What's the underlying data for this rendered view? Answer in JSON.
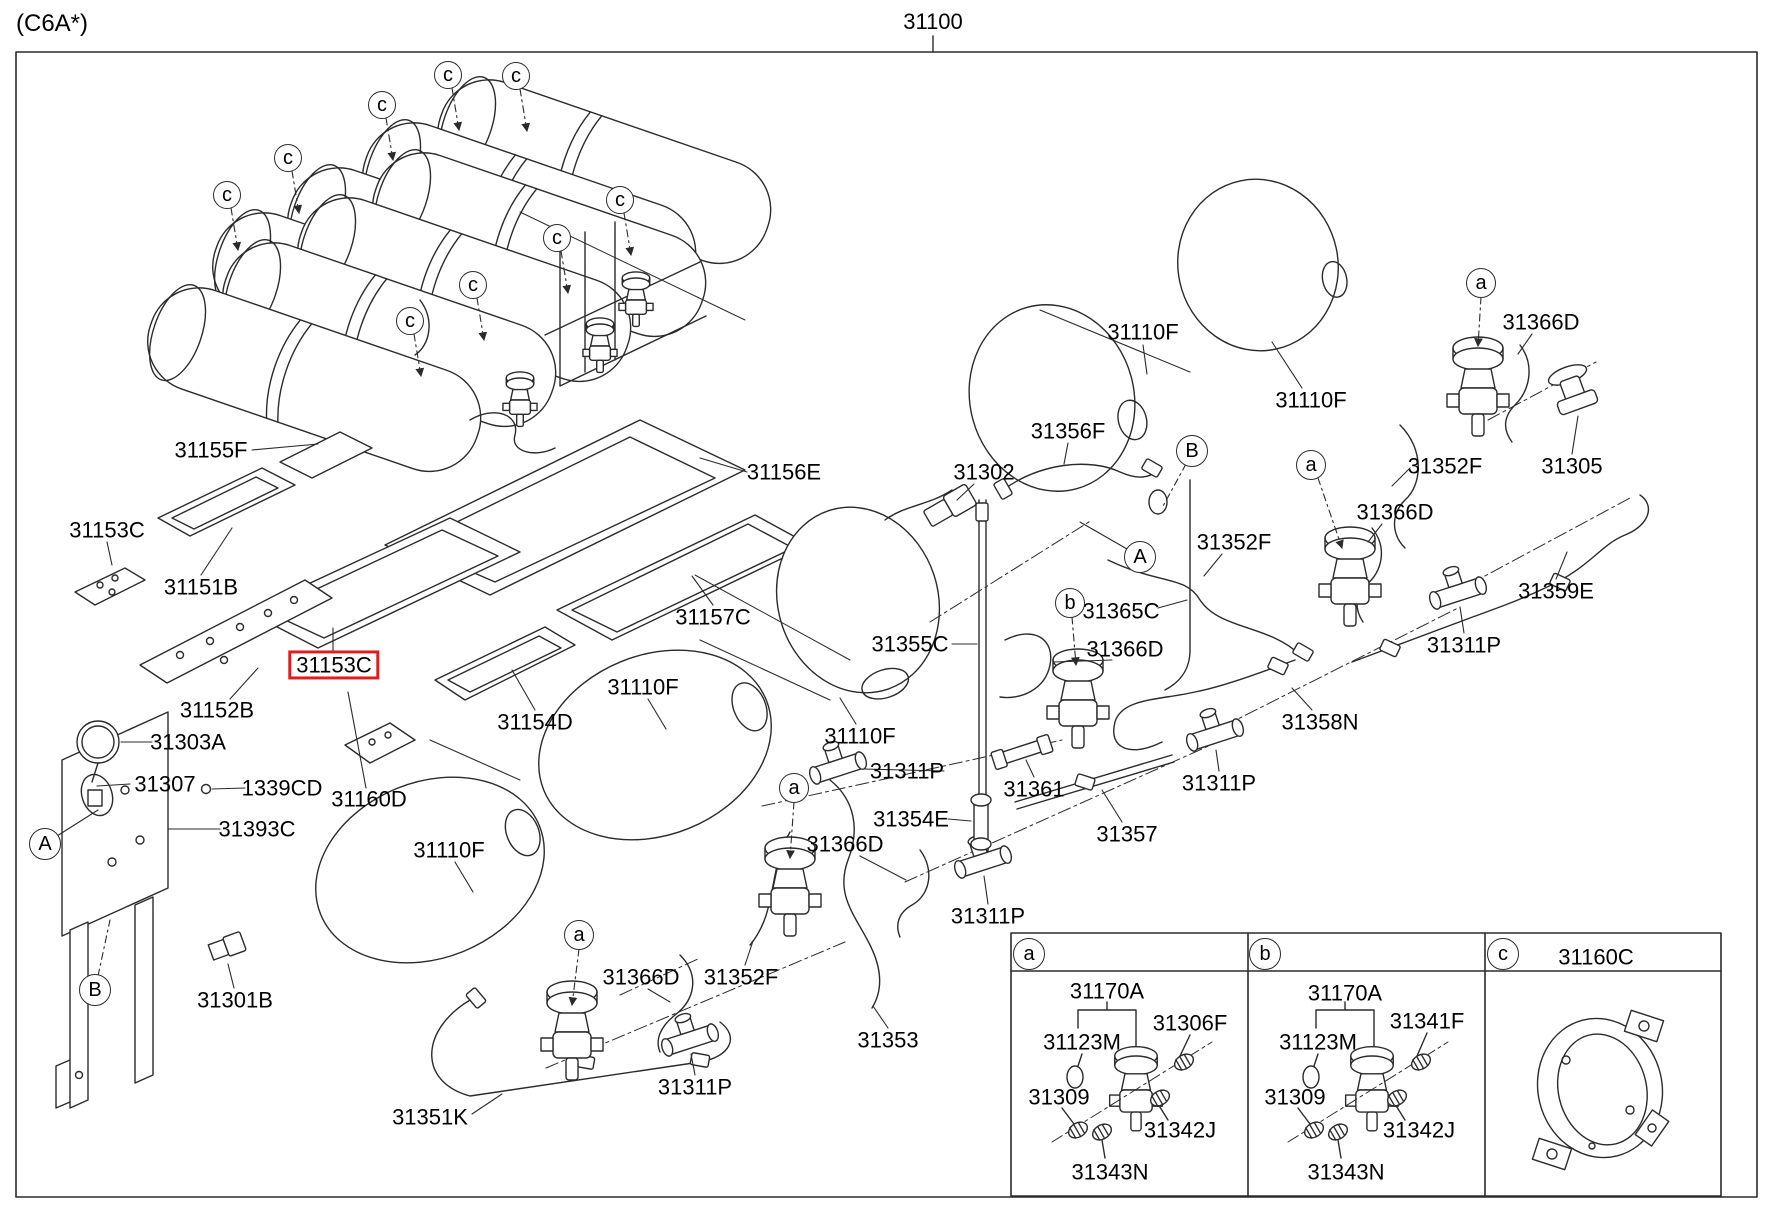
{
  "header": {
    "variant_code": "(C6A*)",
    "assembly_number": "31100"
  },
  "colors": {
    "highlight": "#dd1f1f",
    "line": "#2b2b2b",
    "text": "#000000",
    "background": "#ffffff"
  },
  "highlighted_part": "31153C",
  "labels": [
    {
      "t": "31155F",
      "x": 211,
      "y": 450
    },
    {
      "t": "31153C",
      "x": 107,
      "y": 530
    },
    {
      "t": "31151B",
      "x": 201,
      "y": 587
    },
    {
      "t": "31153C",
      "x": 334,
      "y": 665,
      "hl": true
    },
    {
      "t": "31152B",
      "x": 217,
      "y": 710
    },
    {
      "t": "31303A",
      "x": 188,
      "y": 742
    },
    {
      "t": "31307",
      "x": 165,
      "y": 784
    },
    {
      "t": "1339CD",
      "x": 282,
      "y": 788
    },
    {
      "t": "31160D",
      "x": 369,
      "y": 799
    },
    {
      "t": "31393C",
      "x": 257,
      "y": 829
    },
    {
      "t": "31301B",
      "x": 235,
      "y": 1000
    },
    {
      "t": "31156E",
      "x": 784,
      "y": 472
    },
    {
      "t": "31157C",
      "x": 713,
      "y": 617
    },
    {
      "t": "31154D",
      "x": 535,
      "y": 722
    },
    {
      "t": "31110F",
      "x": 643,
      "y": 687
    },
    {
      "t": "31110F",
      "x": 449,
      "y": 850
    },
    {
      "t": "31110F",
      "x": 860,
      "y": 736
    },
    {
      "t": "31110F",
      "x": 1143,
      "y": 332
    },
    {
      "t": "31110F",
      "x": 1311,
      "y": 400
    },
    {
      "t": "31366D",
      "x": 641,
      "y": 977
    },
    {
      "t": "31366D",
      "x": 845,
      "y": 844
    },
    {
      "t": "31366D",
      "x": 1125,
      "y": 649
    },
    {
      "t": "31366D",
      "x": 1395,
      "y": 512
    },
    {
      "t": "31366D",
      "x": 1541,
      "y": 322
    },
    {
      "t": "31352F",
      "x": 741,
      "y": 977
    },
    {
      "t": "31352F",
      "x": 1234,
      "y": 542
    },
    {
      "t": "31352F",
      "x": 1445,
      "y": 466
    },
    {
      "t": "31311P",
      "x": 907,
      "y": 771
    },
    {
      "t": "31311P",
      "x": 988,
      "y": 916
    },
    {
      "t": "31311P",
      "x": 1219,
      "y": 783
    },
    {
      "t": "31311P",
      "x": 1464,
      "y": 645
    },
    {
      "t": "31311P",
      "x": 695,
      "y": 1087
    },
    {
      "t": "31361",
      "x": 1034,
      "y": 789
    },
    {
      "t": "31354E",
      "x": 911,
      "y": 819
    },
    {
      "t": "31357",
      "x": 1127,
      "y": 834
    },
    {
      "t": "31353",
      "x": 888,
      "y": 1040
    },
    {
      "t": "31351K",
      "x": 430,
      "y": 1117
    },
    {
      "t": "31355C",
      "x": 910,
      "y": 644
    },
    {
      "t": "31365C",
      "x": 1121,
      "y": 611
    },
    {
      "t": "31302",
      "x": 984,
      "y": 472
    },
    {
      "t": "31356F",
      "x": 1068,
      "y": 431
    },
    {
      "t": "31359E",
      "x": 1556,
      "y": 591
    },
    {
      "t": "31358N",
      "x": 1320,
      "y": 722
    },
    {
      "t": "31305",
      "x": 1572,
      "y": 466
    },
    {
      "t": "31160C",
      "x": 1596,
      "y": 957
    },
    {
      "t": "31170A",
      "x": 1107,
      "y": 991
    },
    {
      "t": "31123M",
      "x": 1082,
      "y": 1042
    },
    {
      "t": "31306F",
      "x": 1190,
      "y": 1023
    },
    {
      "t": "31309",
      "x": 1059,
      "y": 1097
    },
    {
      "t": "31342J",
      "x": 1180,
      "y": 1130
    },
    {
      "t": "31343N",
      "x": 1110,
      "y": 1172
    },
    {
      "t": "31170A",
      "x": 1345,
      "y": 993
    },
    {
      "t": "31123M",
      "x": 1318,
      "y": 1042
    },
    {
      "t": "31341F",
      "x": 1427,
      "y": 1021
    },
    {
      "t": "31309",
      "x": 1295,
      "y": 1097
    },
    {
      "t": "31342J",
      "x": 1419,
      "y": 1130
    },
    {
      "t": "31343N",
      "x": 1346,
      "y": 1172
    }
  ],
  "callouts": [
    {
      "t": "A",
      "x": 45,
      "y": 844,
      "r": 15,
      "line": [
        57,
        836,
        98,
        810
      ]
    },
    {
      "t": "A",
      "x": 1140,
      "y": 557,
      "r": 15,
      "line": [
        1127,
        549,
        1080,
        522
      ]
    },
    {
      "t": "B",
      "x": 95,
      "y": 990,
      "r": 15,
      "line": [
        98,
        976,
        110,
        920
      ],
      "dash": true
    },
    {
      "t": "B",
      "x": 1192,
      "y": 451,
      "r": 15,
      "line": [
        1186,
        464,
        1162,
        508
      ],
      "dash": true
    },
    {
      "t": "a",
      "x": 579,
      "y": 935,
      "r": 14,
      "line": [
        579,
        949,
        572,
        1005
      ],
      "dash": true,
      "arrow": true
    },
    {
      "t": "a",
      "x": 794,
      "y": 788,
      "r": 14,
      "line": [
        794,
        802,
        790,
        858
      ],
      "dash": true,
      "arrow": true
    },
    {
      "t": "a",
      "x": 1311,
      "y": 465,
      "r": 14,
      "line": [
        1318,
        478,
        1342,
        548
      ],
      "dash": true,
      "arrow": true
    },
    {
      "t": "a",
      "x": 1481,
      "y": 283,
      "r": 14,
      "line": [
        1481,
        297,
        1478,
        346
      ],
      "dash": true,
      "arrow": true
    },
    {
      "t": "b",
      "x": 1070,
      "y": 603,
      "r": 14,
      "line": [
        1072,
        617,
        1076,
        665
      ],
      "dash": true,
      "arrow": true
    },
    {
      "t": "c",
      "x": 227,
      "y": 195,
      "r": 13,
      "line": [
        231,
        208,
        238,
        250
      ],
      "dash": true,
      "arrow": true
    },
    {
      "t": "c",
      "x": 288,
      "y": 158,
      "r": 13,
      "line": [
        292,
        171,
        299,
        213
      ],
      "dash": true,
      "arrow": true
    },
    {
      "t": "c",
      "x": 382,
      "y": 105,
      "r": 13,
      "line": [
        386,
        118,
        393,
        160
      ],
      "dash": true,
      "arrow": true
    },
    {
      "t": "c",
      "x": 448,
      "y": 75,
      "r": 13,
      "line": [
        452,
        88,
        459,
        130
      ],
      "dash": true,
      "arrow": true
    },
    {
      "t": "c",
      "x": 516,
      "y": 76,
      "r": 13,
      "line": [
        520,
        89,
        527,
        131
      ],
      "dash": true,
      "arrow": true
    },
    {
      "t": "c",
      "x": 620,
      "y": 200,
      "r": 13,
      "line": [
        624,
        213,
        631,
        255
      ],
      "dash": true,
      "arrow": true
    },
    {
      "t": "c",
      "x": 557,
      "y": 238,
      "r": 13,
      "line": [
        561,
        251,
        568,
        293
      ],
      "dash": true,
      "arrow": true
    },
    {
      "t": "c",
      "x": 473,
      "y": 285,
      "r": 13,
      "line": [
        477,
        298,
        484,
        340
      ],
      "dash": true,
      "arrow": true
    },
    {
      "t": "c",
      "x": 410,
      "y": 321,
      "r": 13,
      "line": [
        414,
        334,
        421,
        376
      ],
      "dash": true,
      "arrow": true
    },
    {
      "t": "a",
      "x": 1029,
      "y": 954,
      "r": 15
    },
    {
      "t": "b",
      "x": 1265,
      "y": 954,
      "r": 15
    },
    {
      "t": "c",
      "x": 1503,
      "y": 954,
      "r": 15
    }
  ],
  "legend": {
    "cells": [
      {
        "key": "a"
      },
      {
        "key": "b"
      },
      {
        "key": "c",
        "part": "31160C"
      }
    ]
  }
}
